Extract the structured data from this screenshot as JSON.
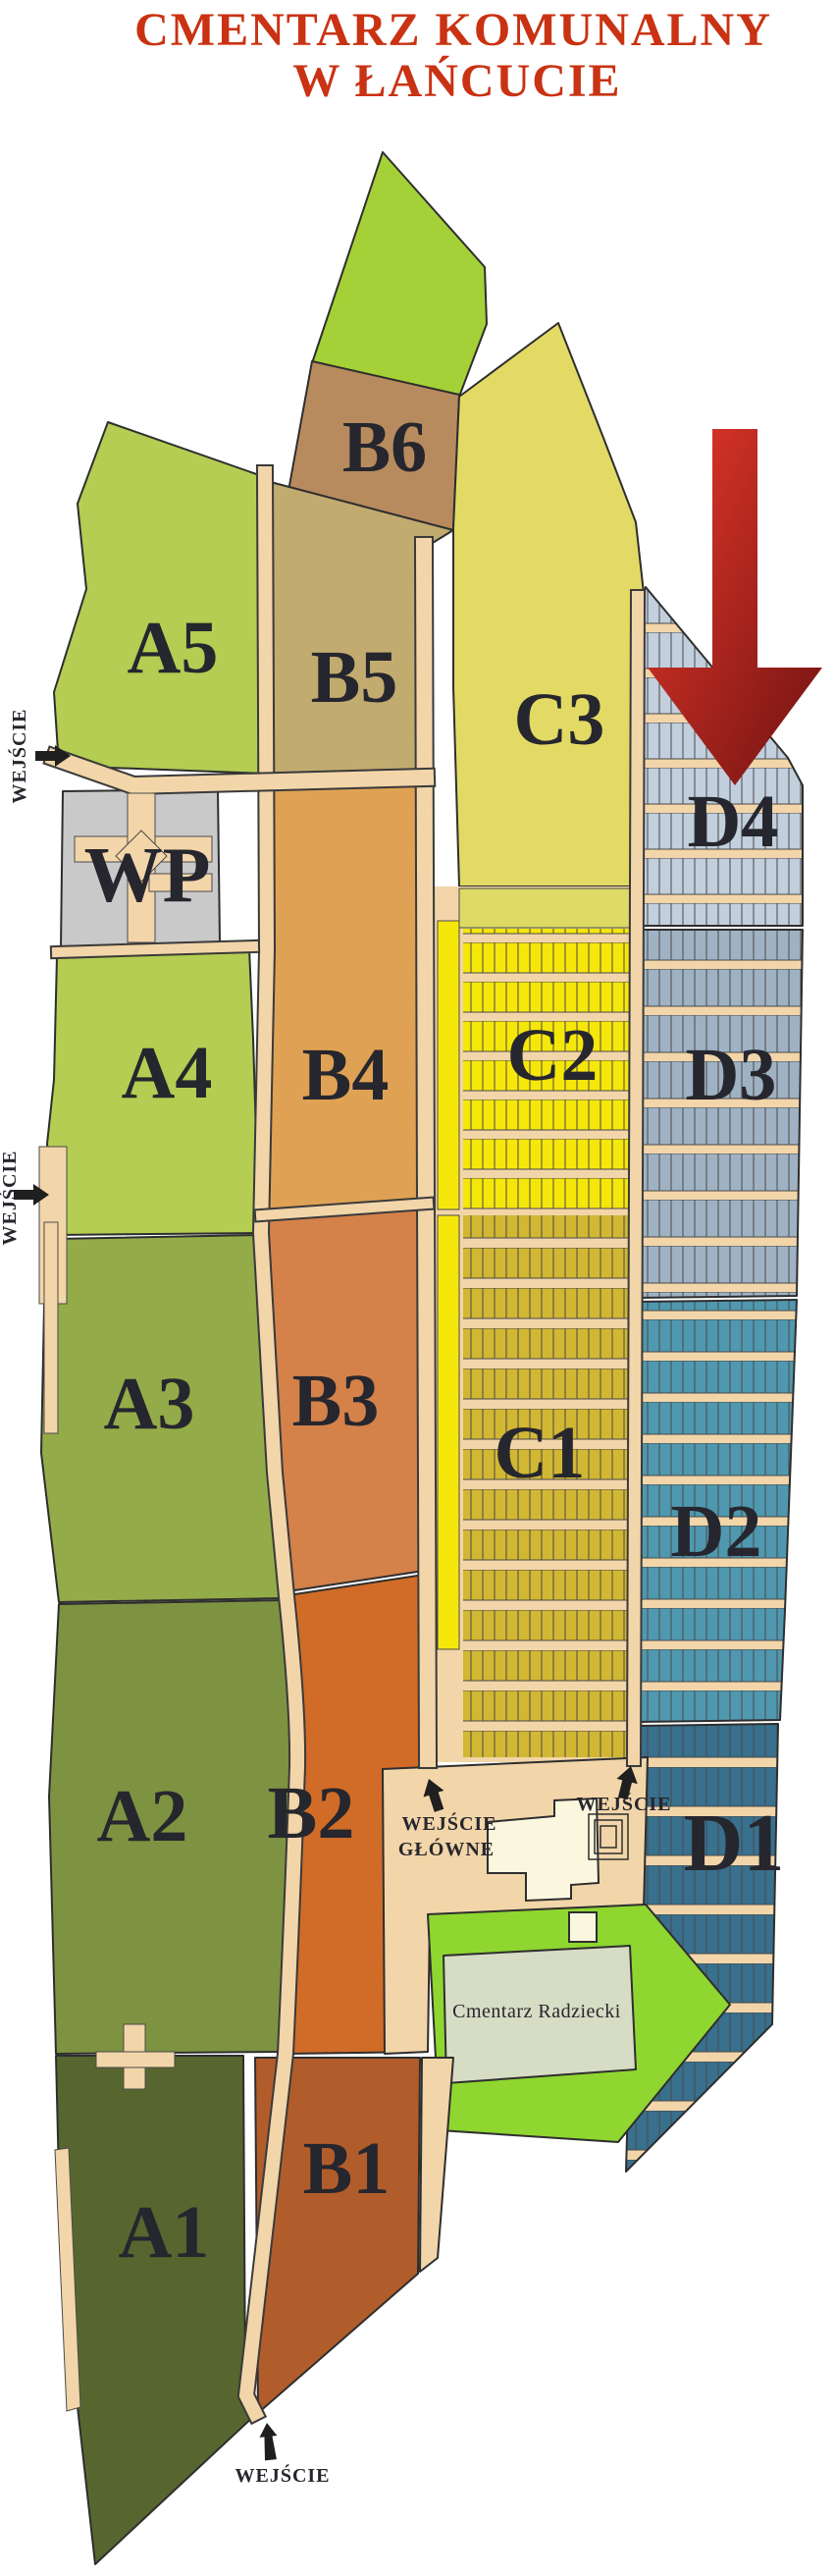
{
  "title": {
    "line1": "CMENTARZ  KOMUNALNY",
    "line2": "W ŁAŃCUCIE",
    "color": "#C93212"
  },
  "map": {
    "sections": {
      "a1": {
        "label": "A1",
        "color": "#57662F"
      },
      "a2": {
        "label": "A2",
        "color": "#7E9341"
      },
      "a3": {
        "label": "A3",
        "color": "#94AB49"
      },
      "a4": {
        "label": "A4",
        "color": "#B4CD52"
      },
      "a5": {
        "label": "A5",
        "color": "#B4CD52"
      },
      "b1": {
        "label": "B1",
        "color": "#B15D2B"
      },
      "b2": {
        "label": "B2",
        "color": "#D06C27"
      },
      "b3": {
        "label": "B3",
        "color": "#D4814A"
      },
      "b4": {
        "label": "B4",
        "color": "#DFA254"
      },
      "b5": {
        "label": "B5",
        "color": "#C2AB6F"
      },
      "b6": {
        "label": "B6",
        "color": "#B78B5E"
      },
      "c1": {
        "label": "C1",
        "color": "#D2B733"
      },
      "c2": {
        "label": "C2",
        "color": "#F6E70A",
        "band_color": "#DFD966"
      },
      "c3": {
        "label": "C3",
        "color": "#E2DA65"
      },
      "d1": {
        "label": "D1",
        "color": "#38708D"
      },
      "d2": {
        "label": "D2",
        "color": "#4F98AF"
      },
      "d3": {
        "label": "D3",
        "color": "#9FB2C3"
      },
      "d4": {
        "label": "D4",
        "color": "#C2CFDD"
      },
      "wp": {
        "label": "WP",
        "color": "#C9C9C9"
      },
      "green_north": {
        "color": "#A5D138"
      },
      "green_south": {
        "color": "#8FD630"
      },
      "radziecki": {
        "label": "Cmentarz Radziecki",
        "color": "#D7DCC4"
      }
    },
    "entrances": {
      "west_upper": {
        "label": "WEJŚCIE"
      },
      "west_lower": {
        "label": "WEJŚCIE"
      },
      "main": {
        "label_line1": "WEJŚCIE",
        "label_line2": "GŁÓWNE"
      },
      "east": {
        "label": "WEJŚCIE"
      },
      "south": {
        "label": "WEJŚCIE"
      }
    },
    "colors": {
      "path": "#F2D5A9",
      "building": "#FBF7DF",
      "outline": "#2E2E2E",
      "label": "#26262E",
      "arrow_red_light": "#E8392A",
      "arrow_red_dark": "#6F1212",
      "entrance_arrow": "#1F1F1F"
    }
  }
}
